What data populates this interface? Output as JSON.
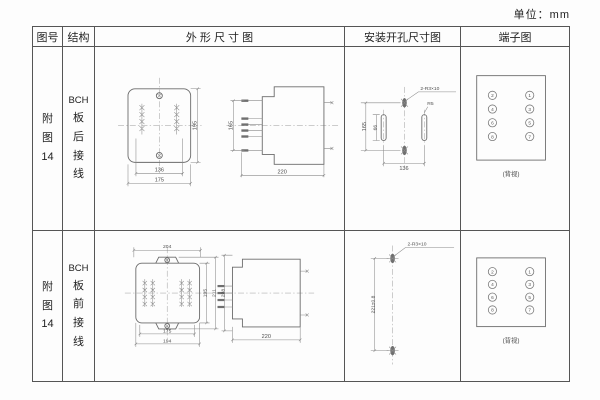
{
  "unit_label": "单位：mm",
  "header": {
    "figure_no": "图号",
    "structure": "结构",
    "outline": "外 形 尺 寸 图",
    "mounting": "安装开孔尺寸图",
    "terminal": "端子图"
  },
  "rows": [
    {
      "figure_chars": [
        "附",
        "图",
        "14"
      ],
      "structure_chars": [
        "BCH",
        "板",
        "后",
        "接",
        "线"
      ],
      "outline": {
        "front_width_inner": "136",
        "front_width_outer": "175",
        "front_height": "195",
        "side_height": "165",
        "side_depth": "220"
      },
      "mounting": {
        "callout": "2-R3×10",
        "height": "165",
        "slot_length": "66",
        "slot_radius": "R5",
        "width": "136"
      },
      "terminal": {
        "left": [
          "2",
          "4",
          "6",
          "8"
        ],
        "right": [
          "1",
          "3",
          "5",
          "7"
        ],
        "caption": "(背视)"
      }
    },
    {
      "figure_chars": [
        "附",
        "图",
        "14"
      ],
      "structure_chars": [
        "BCH",
        "板",
        "前",
        "接",
        "线"
      ],
      "outline": {
        "front_width_top": "204",
        "front_width_inner": "175",
        "front_width_outer": "194",
        "front_height_inner": "195",
        "front_height_outer": "211",
        "side_height": "228",
        "side_depth": "220"
      },
      "mounting": {
        "callout": "2-R3×10",
        "height": "221±0.8"
      },
      "terminal": {
        "left": [
          "2",
          "4",
          "6",
          "8"
        ],
        "right": [
          "1",
          "3",
          "5",
          "7"
        ],
        "caption": "(背视)"
      }
    }
  ]
}
